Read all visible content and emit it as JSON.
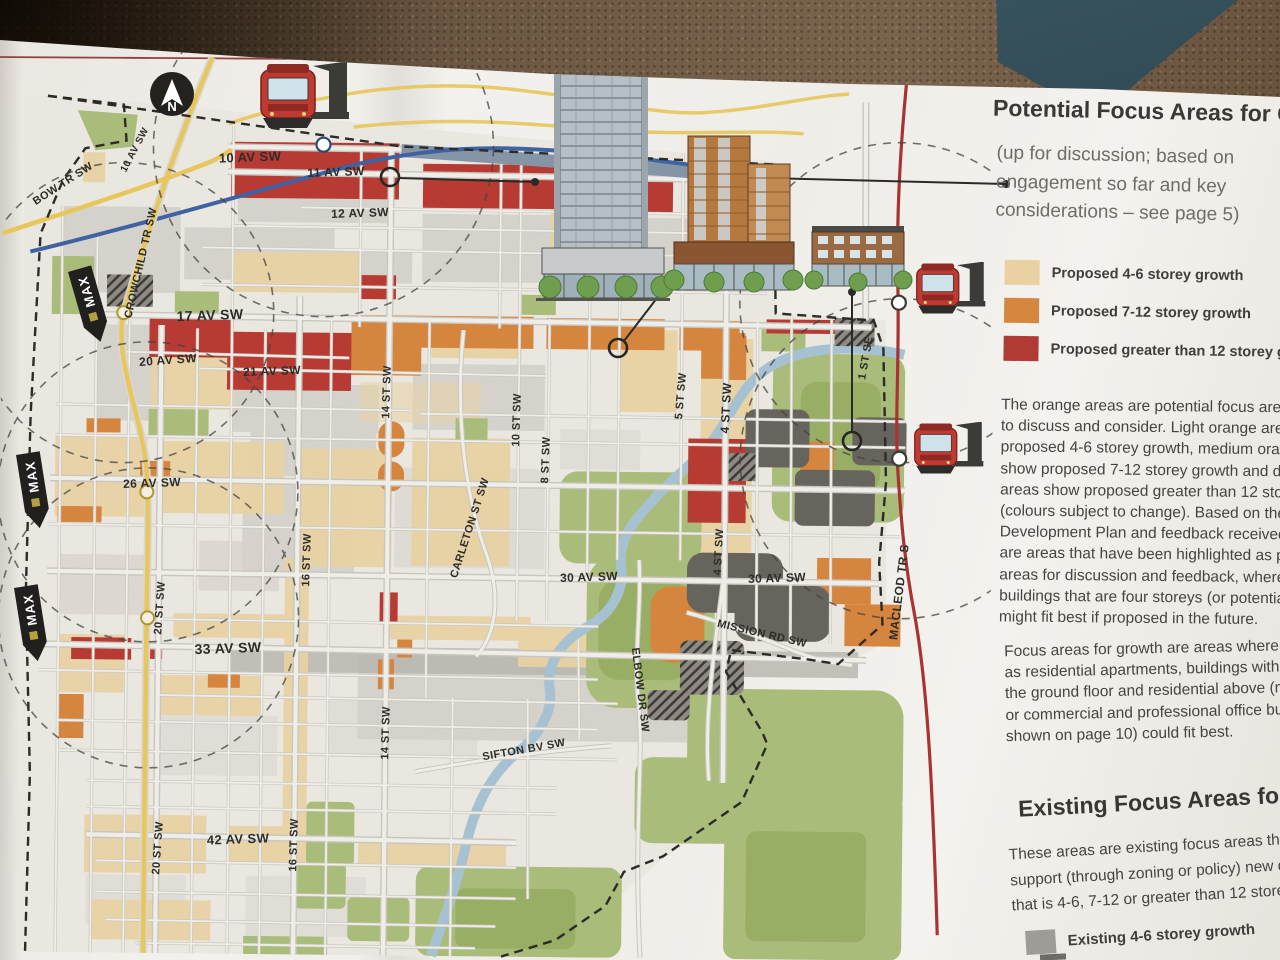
{
  "column": {
    "heading": "Potential Focus Areas for Gro",
    "subheading_lines": [
      "(up for discussion; based on",
      "engagement so far and key",
      "considerations – see page 5)"
    ],
    "legend_proposed": [
      {
        "label": "Proposed 4-6 storey growth",
        "color": "#e9d1a2"
      },
      {
        "label": "Proposed 7-12 storey growth",
        "color": "#d5873f"
      },
      {
        "label": "Proposed greater than 12 storey growth",
        "color": "#b03b35"
      }
    ],
    "paragraph1_lines": [
      "The orange areas are potential focus areas for",
      "to discuss and consider. Light orange areas sh",
      "proposed 4-6 storey growth, medium orange",
      "show proposed 7-12 storey growth and dark o",
      "areas show proposed greater than 12 storey g",
      "(colours subject to change). Based on the Mu",
      "Development Plan and feedback received so",
      "are areas that have been highlighted as pote",
      "areas for discussion and feedback, where nev",
      "buildings that are four storeys (or potentially",
      "might fit best if proposed in the future."
    ],
    "paragraph2_lines": [
      "Focus areas for growth are areas where buil",
      "as residential apartments, buildings with sho",
      "the ground floor and residential above (mixe",
      "or commercial and professional office buildi",
      "shown on page 10) could fit best."
    ],
    "existing_heading": "Existing Focus Areas for G",
    "paragraph3_lines": [
      "These areas are existing focus areas that alr",
      "support (through zoning or policy) new dev",
      "that is 4-6, 7-12 or greater than 12 storeys."
    ],
    "legend_existing": [
      {
        "label": "Existing 4-6 storey growth",
        "color": "#9f9c98"
      }
    ]
  },
  "map": {
    "north_letter": "N",
    "max_label": "MAX",
    "street_labels": [
      {
        "t": "10 AV SW",
        "x": 250,
        "y": 157,
        "r": -2,
        "s": 13
      },
      {
        "t": "11 AV SW",
        "x": 336,
        "y": 172,
        "r": -2,
        "s": 12
      },
      {
        "t": "12 AV SW",
        "x": 360,
        "y": 213,
        "r": -2,
        "s": 12
      },
      {
        "t": "BOW TR SW",
        "x": 63,
        "y": 184,
        "r": -33,
        "s": 11
      },
      {
        "t": "10 AV SW",
        "x": 135,
        "y": 150,
        "r": -62,
        "s": 10
      },
      {
        "t": "CROWCHILD TR SW",
        "x": 141,
        "y": 263,
        "r": -77,
        "s": 11
      },
      {
        "t": "17 AV SW",
        "x": 210,
        "y": 315,
        "r": -2,
        "s": 14
      },
      {
        "t": "20 AV SW",
        "x": 168,
        "y": 360,
        "r": -4,
        "s": 12
      },
      {
        "t": "21 AV SW",
        "x": 272,
        "y": 371,
        "r": -2,
        "s": 12
      },
      {
        "t": "26 AV SW",
        "x": 152,
        "y": 483,
        "r": -2,
        "s": 12
      },
      {
        "t": "33 AV SW",
        "x": 228,
        "y": 648,
        "r": -2,
        "s": 14
      },
      {
        "t": "42 AV SW",
        "x": 238,
        "y": 839,
        "r": -2,
        "s": 13
      },
      {
        "t": "30 AV SW",
        "x": 589,
        "y": 577,
        "r": -2,
        "s": 12
      },
      {
        "t": "30 AV SW",
        "x": 777,
        "y": 578,
        "r": -2,
        "s": 12
      },
      {
        "t": "MISSION RD SW",
        "x": 762,
        "y": 634,
        "r": 13,
        "s": 11
      },
      {
        "t": "SIFTON BV SW",
        "x": 524,
        "y": 750,
        "r": -10,
        "s": 11
      },
      {
        "t": "ELBOW DR SW",
        "x": 640,
        "y": 690,
        "r": 83,
        "s": 11
      },
      {
        "t": "CARLETON ST SW",
        "x": 470,
        "y": 528,
        "r": -72,
        "s": 11
      },
      {
        "t": "MACLEOD TR S",
        "x": 899,
        "y": 592,
        "r": -83,
        "s": 12
      },
      {
        "t": "14 ST SW",
        "x": 387,
        "y": 392,
        "r": -88,
        "s": 11
      },
      {
        "t": "14 ST SW",
        "x": 386,
        "y": 733,
        "r": -88,
        "s": 11
      },
      {
        "t": "16 ST SW",
        "x": 307,
        "y": 560,
        "r": -88,
        "s": 11
      },
      {
        "t": "16 ST SW",
        "x": 294,
        "y": 845,
        "r": -88,
        "s": 11
      },
      {
        "t": "20 ST SW",
        "x": 160,
        "y": 608,
        "r": -86,
        "s": 11
      },
      {
        "t": "20 ST SW",
        "x": 158,
        "y": 848,
        "r": -86,
        "s": 11
      },
      {
        "t": "10 ST SW",
        "x": 517,
        "y": 420,
        "r": -88,
        "s": 11
      },
      {
        "t": "8 ST SW",
        "x": 546,
        "y": 460,
        "r": -88,
        "s": 11
      },
      {
        "t": "5 ST SW",
        "x": 681,
        "y": 396,
        "r": -85,
        "s": 11
      },
      {
        "t": "4 ST SW",
        "x": 726,
        "y": 408,
        "r": -87,
        "s": 12
      },
      {
        "t": "4 ST SW",
        "x": 719,
        "y": 552,
        "r": -87,
        "s": 11
      },
      {
        "t": "1 ST SE",
        "x": 866,
        "y": 358,
        "r": -80,
        "s": 11
      }
    ]
  }
}
